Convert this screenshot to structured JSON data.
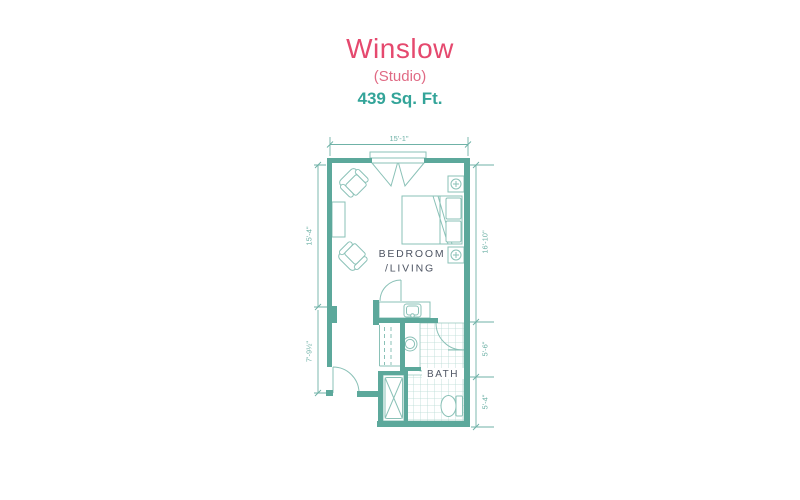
{
  "header": {
    "title": "Winslow",
    "subtitle": "(Studio)",
    "area": "439 Sq. Ft."
  },
  "plan": {
    "room_labels": {
      "bedroom_line1": "BEDROOM",
      "bedroom_line2": "/LIVING",
      "bath": "BATH"
    },
    "dimensions": {
      "top_width": "15'-1\"",
      "left_upper": "15'-4\"",
      "left_lower": "7'-9½\"",
      "right_bedroom": "16'-10\"",
      "right_bath_upper": "5'-6\"",
      "right_bath_lower": "5'-4\""
    },
    "fixture_icons": [
      "double-entry-door-icon",
      "armchair-icon",
      "armchair-icon",
      "console-table-icon",
      "bed-icon",
      "nightstand-lamp-icon",
      "nightstand-lamp-icon",
      "vanity-sink-icon",
      "linen-closet-icon",
      "pedestal-sink-icon",
      "toilet-icon",
      "shower-icon",
      "door-swing-icon"
    ],
    "colors": {
      "wall_teal": "#5ca89b",
      "furniture_teal": "#8ac1b7",
      "dimension_teal": "#6fb2a7",
      "tile_teal": "#b8dad3",
      "label_gray": "#4e5563",
      "title_pink": "#e5496e",
      "subtitle_pink": "#e06a84",
      "area_teal": "#33a499"
    }
  }
}
